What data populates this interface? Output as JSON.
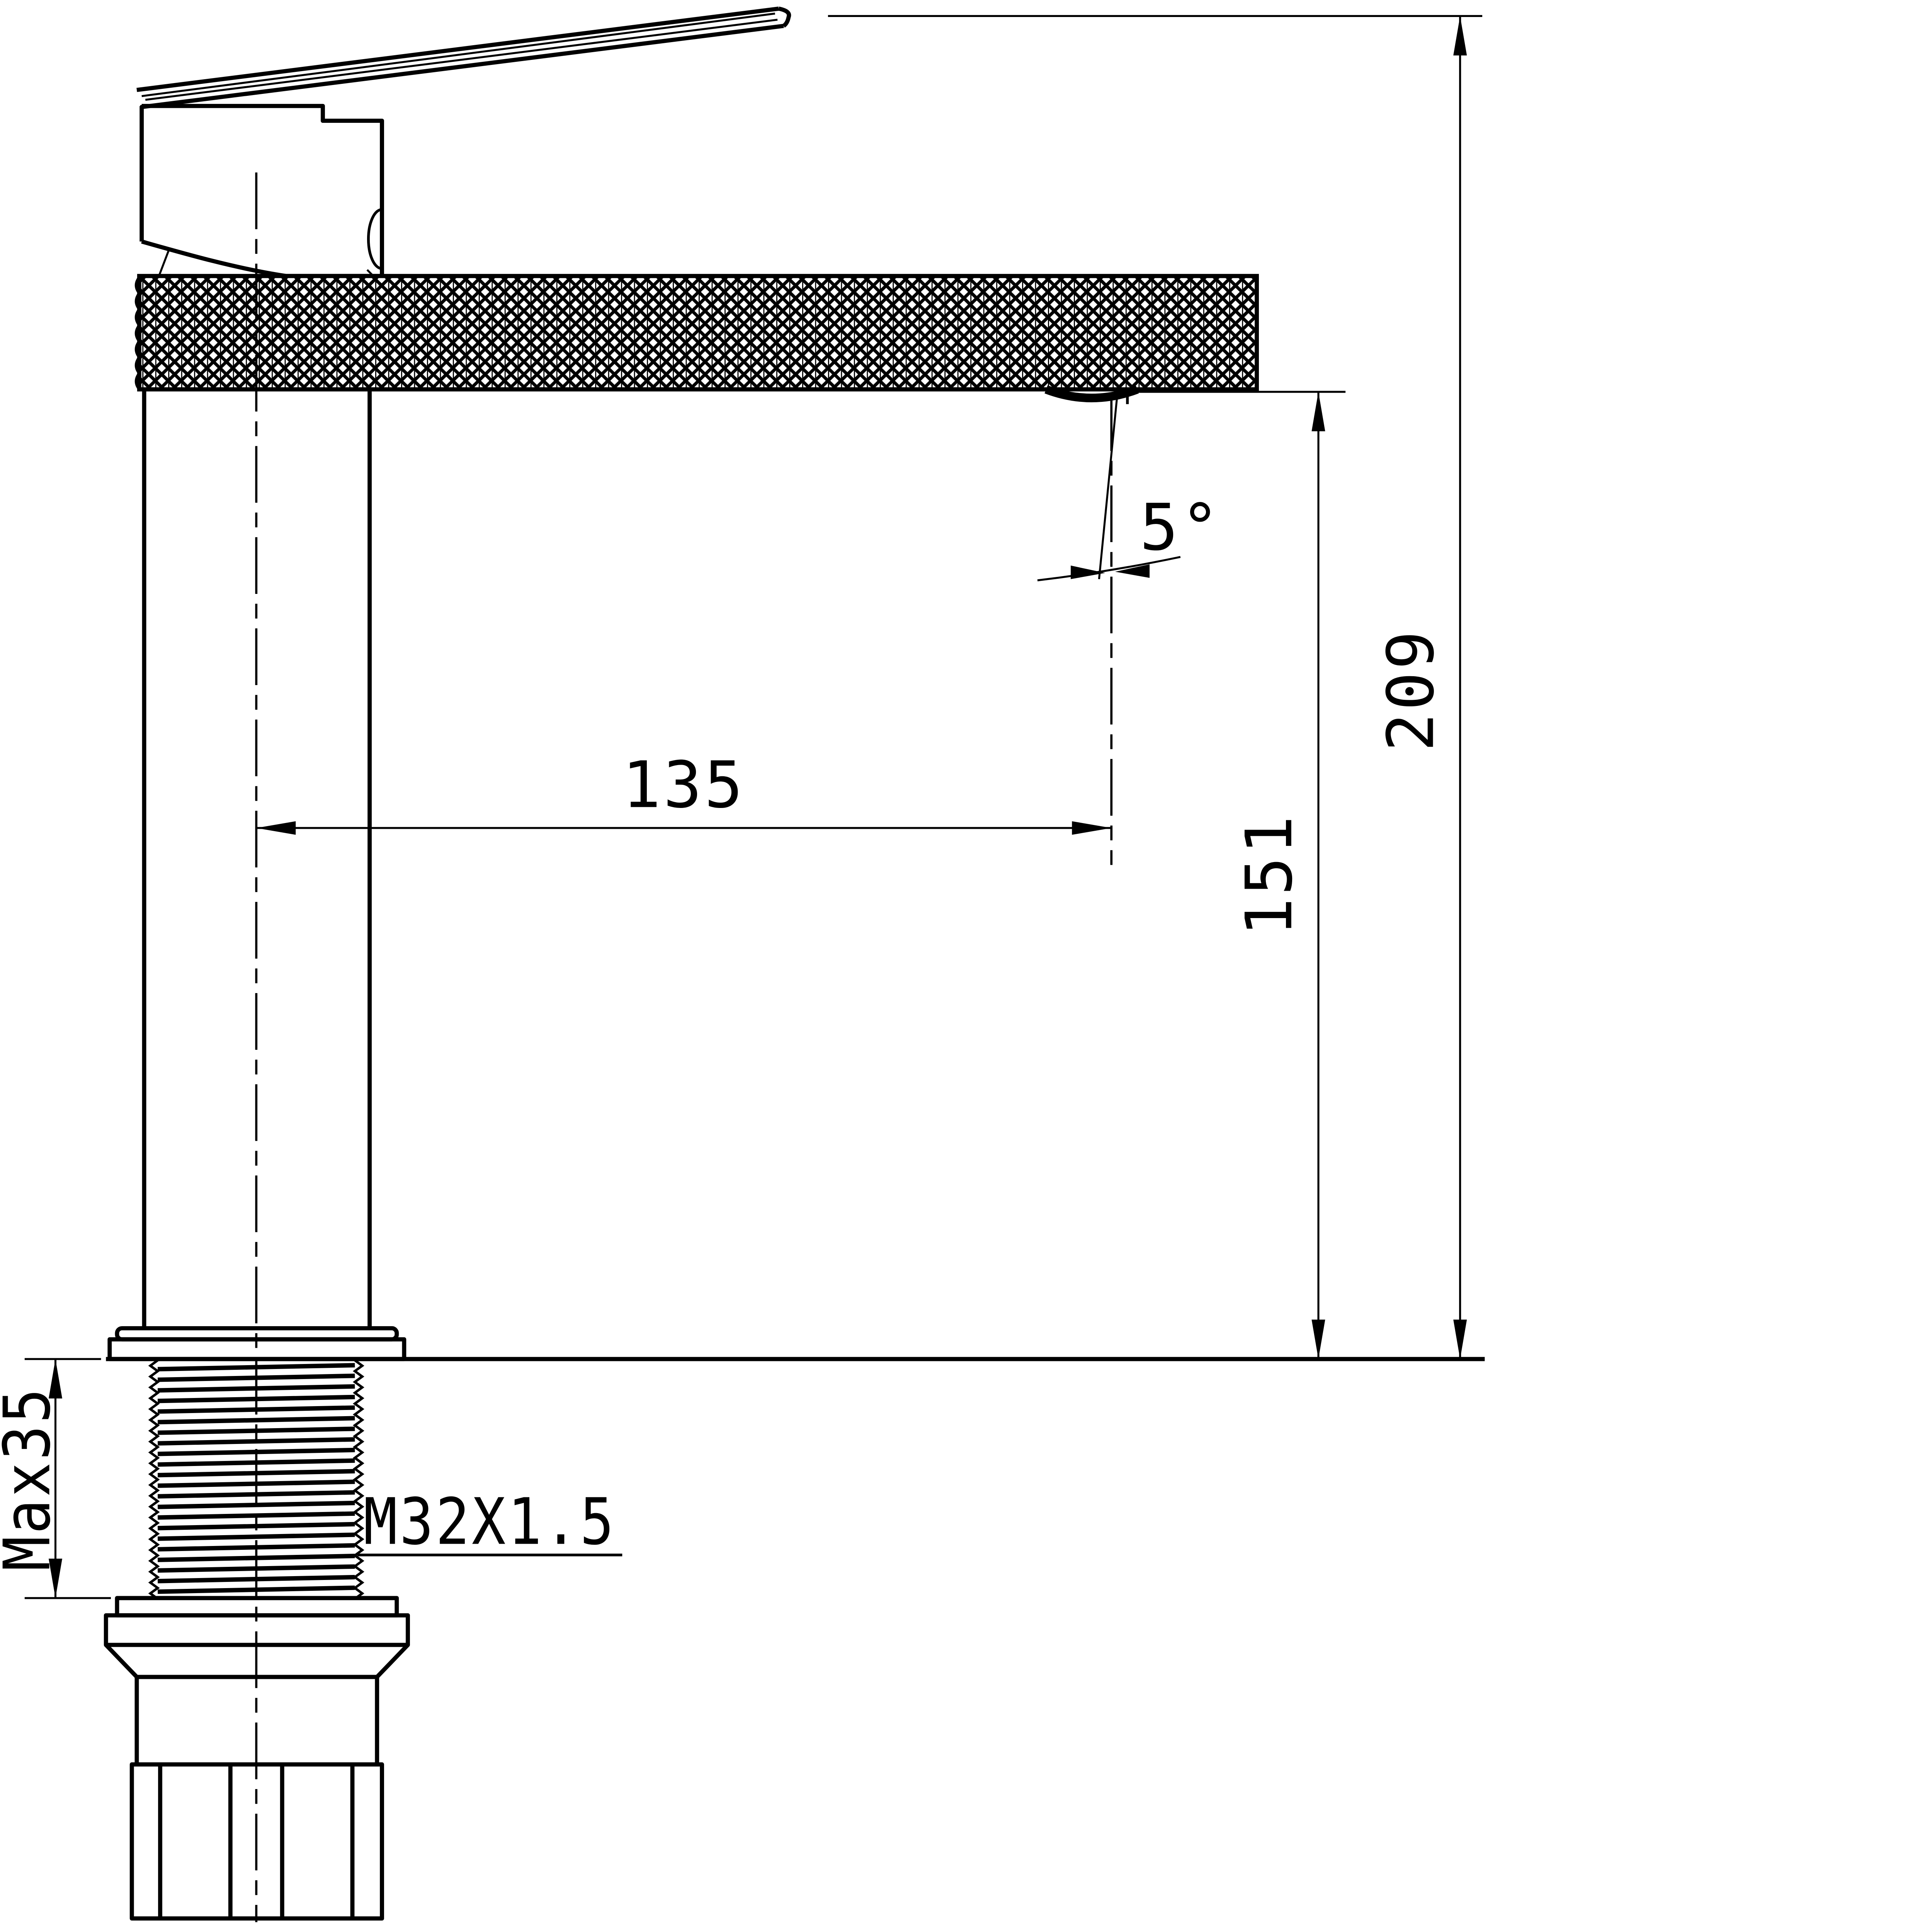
{
  "drawing": {
    "background_color": "#ffffff",
    "line_color": "#000000",
    "labels": {
      "overall_height": "209",
      "spout_height": "151",
      "spout_reach": "135",
      "spout_angle": "5°",
      "thread": "M32X1.5",
      "max_thickness": "Max35"
    }
  }
}
